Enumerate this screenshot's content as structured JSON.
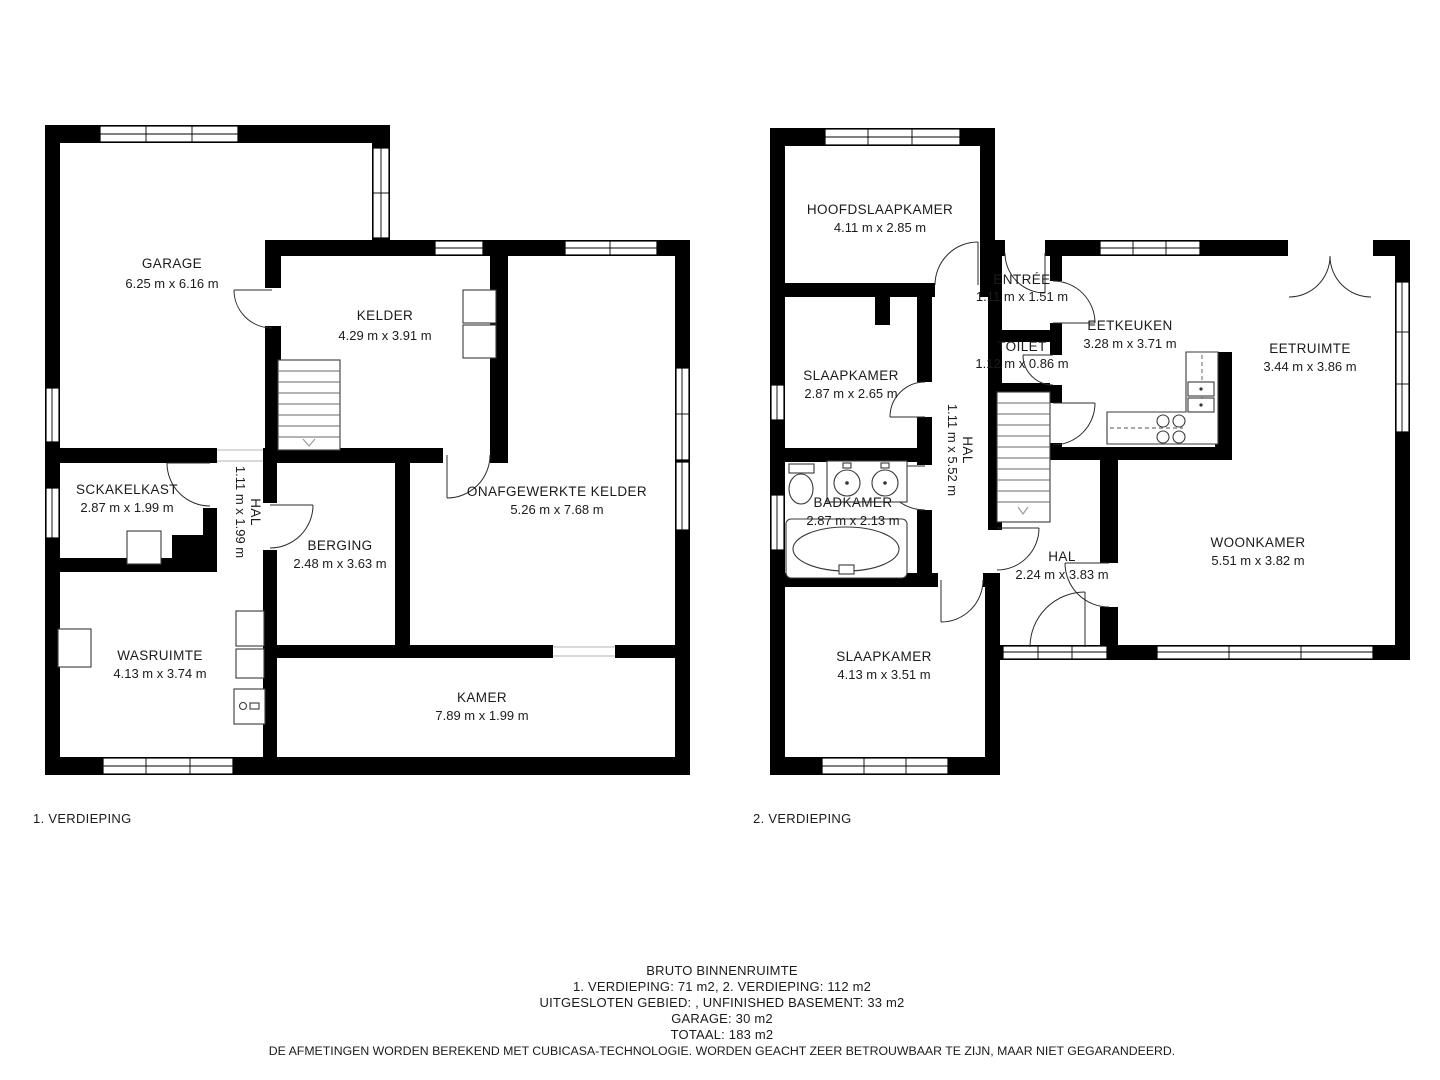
{
  "floor1": {
    "label": "1. VERDIEPING",
    "rooms": {
      "garage": {
        "name": "GARAGE",
        "dims": "6.25 m x 6.16 m"
      },
      "kelder": {
        "name": "KELDER",
        "dims": "4.29 m x 3.91 m"
      },
      "sckakelkast": {
        "name": "SCKAKELKAST",
        "dims": "2.87 m x 1.99 m"
      },
      "hal": {
        "name": "HAL",
        "dims": "1.11 m x 1.99 m"
      },
      "berging": {
        "name": "BERGING",
        "dims": "2.48 m x 3.63 m"
      },
      "onafgewerkte_kelder": {
        "name": "ONAFGEWERKTE KELDER",
        "dims": "5.26 m x 7.68 m"
      },
      "wasruimte": {
        "name": "WASRUIMTE",
        "dims": "4.13 m x 3.74 m"
      },
      "kamer": {
        "name": "KAMER",
        "dims": "7.89 m x 1.99 m"
      }
    },
    "fixtures": [
      "staircase-icon",
      "shelving-icon",
      "appliance-icon",
      "washer-icon",
      "boiler-icon"
    ]
  },
  "floor2": {
    "label": "2. VERDIEPING",
    "rooms": {
      "hoofdslaapkamer": {
        "name": "HOOFDSLAAPKAMER",
        "dims": "4.11 m x 2.85 m"
      },
      "entree": {
        "name": "ENTRÉE",
        "dims": "1.11 m x 1.51 m"
      },
      "slaapkamer1": {
        "name": "SLAAPKAMER",
        "dims": "2.87 m x 2.65 m"
      },
      "toilet": {
        "name": "TOILET",
        "dims": "1.12 m x 0.86 m"
      },
      "eetkeuken": {
        "name": "EETKEUKEN",
        "dims": "3.28 m x 3.71 m"
      },
      "eetruimte": {
        "name": "EETRUIMTE",
        "dims": "3.44 m x 3.86 m"
      },
      "hal_lang": {
        "name": "HAL",
        "dims": "1.11 m x 5.52 m"
      },
      "badkamer": {
        "name": "BADKAMER",
        "dims": "2.87 m x 2.13 m"
      },
      "hal": {
        "name": "HAL",
        "dims": "2.24 m x 3.83 m"
      },
      "woonkamer": {
        "name": "WOONKAMER",
        "dims": "5.51 m x 3.82 m"
      },
      "slaapkamer2": {
        "name": "SLAAPKAMER",
        "dims": "4.13 m x 3.51 m"
      }
    },
    "fixtures": [
      "staircase-icon",
      "toilet-icon",
      "double-sink-icon",
      "bathtub-icon",
      "kitchen-counter-icon",
      "stove-icon",
      "sink-icon"
    ]
  },
  "summary": {
    "title": "BRUTO BINNENRUIMTE",
    "lines": [
      "1. VERDIEPING: 71 m2, 2. VERDIEPING: 112 m2",
      "UITGESLOTEN GEBIED: , UNFINISHED BASEMENT: 33 m2",
      "GARAGE: 30 m2",
      "TOTAAL: 183 m2"
    ],
    "disclaimer": "DE AFMETINGEN WORDEN BEREKEND MET CUBICASA-TECHNOLOGIE. WORDEN GEACHT ZEER BETROUWBAAR TE ZIJN, MAAR NIET GEGARANDEERD."
  },
  "colors": {
    "wall": "#000000",
    "background": "#ffffff",
    "text": "#1b1b1b"
  }
}
